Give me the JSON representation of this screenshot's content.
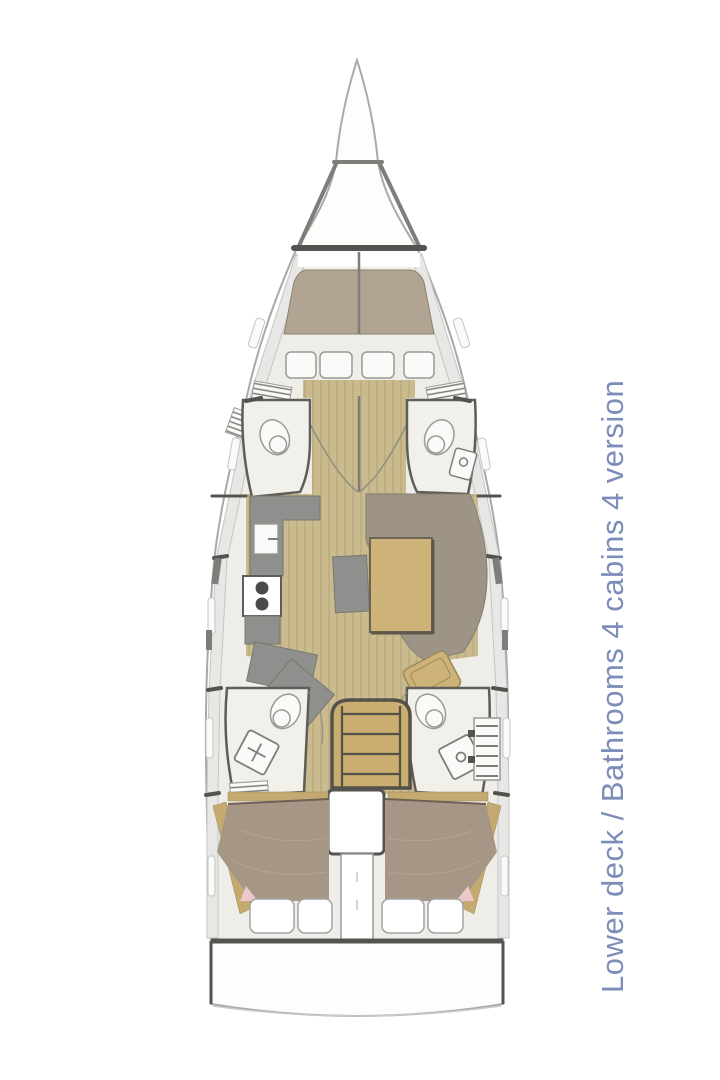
{
  "caption": {
    "text": "Lower deck / Bathrooms 4 cabins 4 version",
    "color": "#7d8db9"
  },
  "colors": {
    "hull_fill": "#fdfdfc",
    "hull_stroke": "#a9a9a7",
    "outline_dark": "#55534f",
    "outline_mid": "#7d7d7a",
    "wall_stroke": "#5f5d59",
    "cream": "#efede7",
    "room_cream": "#f2f0ea",
    "side_band": "#e7e7e5",
    "band_stroke": "#c5c5c3",
    "wood": "#cabb8e",
    "wood_line": "#b7a77a",
    "bed_fwd": "#b2a492",
    "bed_fwd_stroke": "#8d8172",
    "bed_aft": "#a69686",
    "bed_aft_stroke": "#6d6054",
    "bed_streak": "#b5a392",
    "sofa": "#9d9486",
    "sofa_stroke": "#857d70",
    "galley": "#8f8f8d",
    "galley_stroke": "#77776f",
    "table_tan": "#cdb377",
    "table_stroke": "#6b6452",
    "table_shadow": "#5e584b",
    "stairs_tan": "#c9ae70",
    "stairs_stroke": "#54504a",
    "accent_tan": "#c4aa70",
    "accent_stroke": "#9a8a5c",
    "white": "#ffffff",
    "fixture_fill": "#fafaf8",
    "fixture_stroke": "#9a9a96",
    "arc_stroke": "#8f8f83",
    "pink": "#ecc8cc",
    "burner": "#4a4a48",
    "pillow_stroke": "#a3a3a1",
    "transom_curve": "#c9c9c7"
  }
}
